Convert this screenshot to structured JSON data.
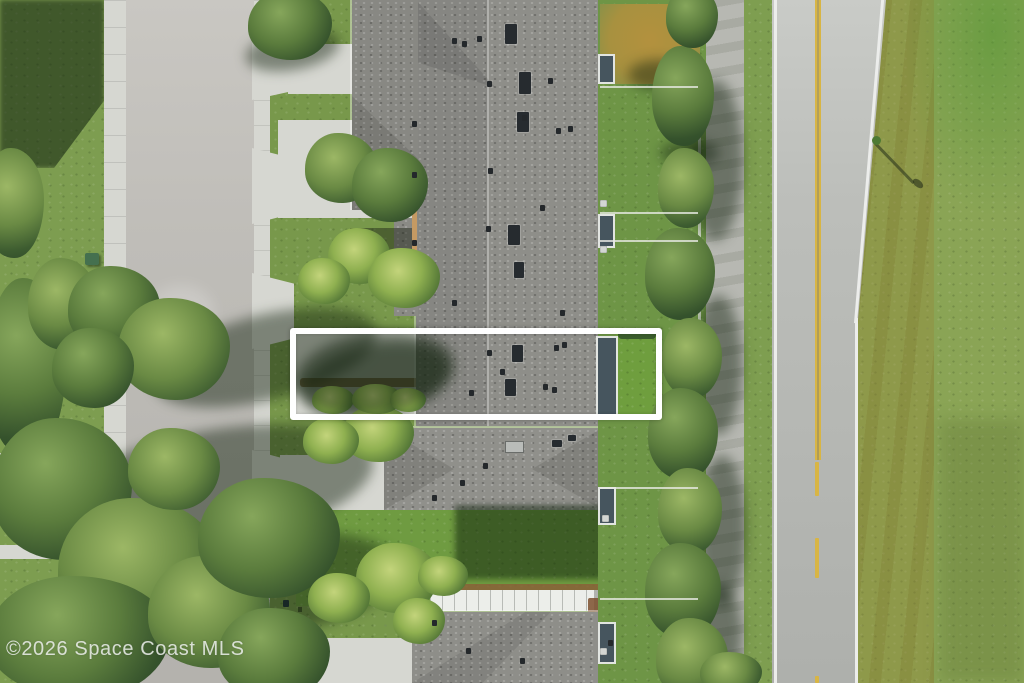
{
  "watermark": {
    "text": "©2026 Space Coast MLS"
  },
  "annotation": {
    "type": "highlight-rectangle",
    "color": "#ffffff"
  },
  "road_markings": {
    "center_line_color": "#d8b544",
    "edge_line_color": "#ecedeb",
    "center_line_style_top": "double-solid",
    "center_line_style_bottom": "dashed"
  },
  "palette": {
    "grass": "#7a9a4c",
    "field_grass": "#8aa455",
    "asphalt_street": "#bfbdb8",
    "asphalt_road": "#b6b8b4",
    "concrete": "#d6d7d1",
    "roof_gray": "#8e8e89",
    "dead_grass": "#b3913e",
    "lawn_bright": "#6f9b41",
    "deep_shadow": "#1c3414"
  }
}
